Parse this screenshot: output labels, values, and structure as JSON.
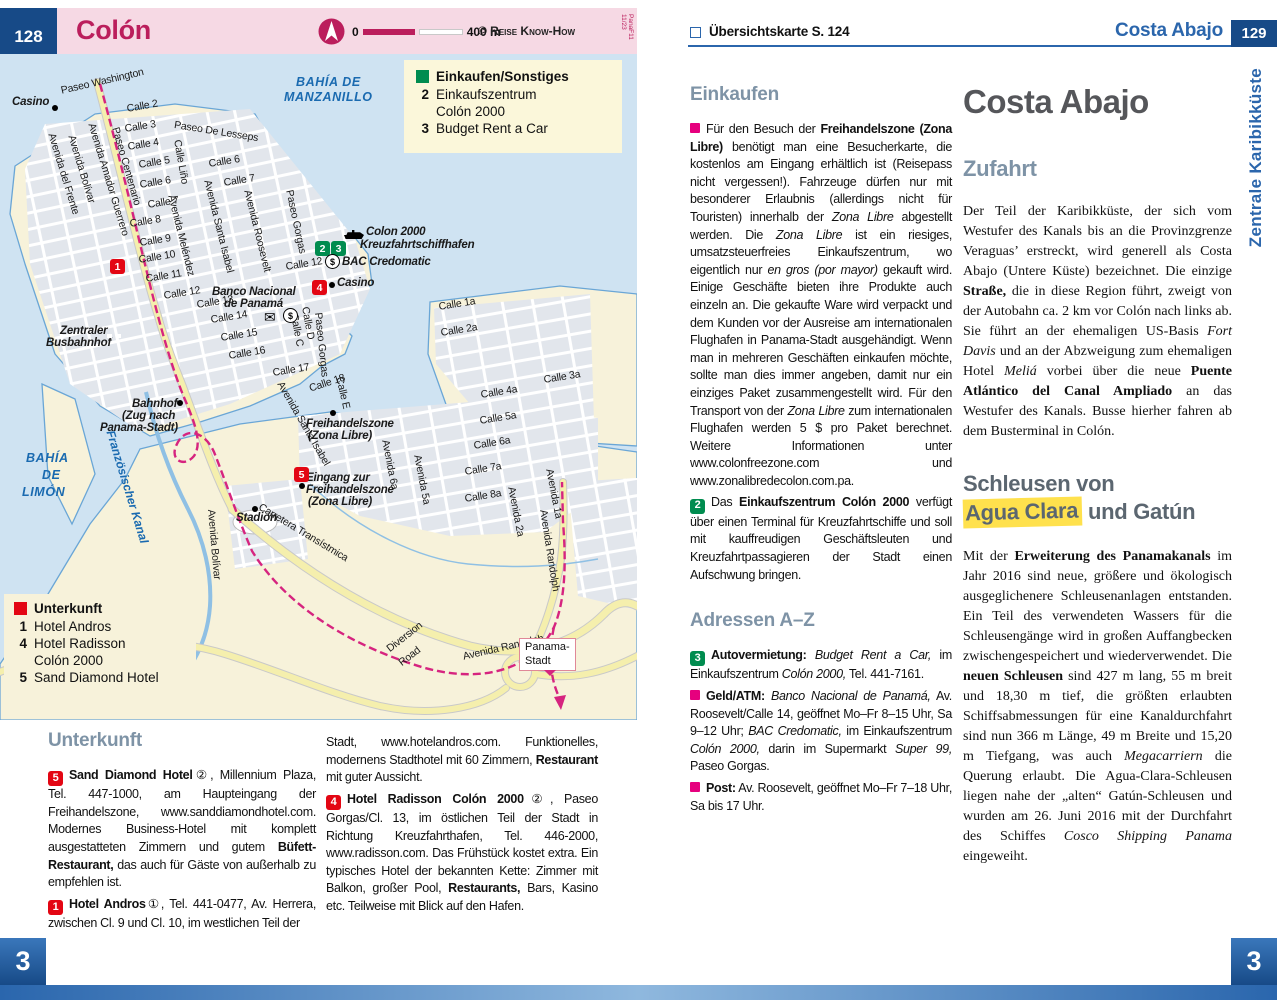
{
  "colors": {
    "accent_blue": "#2b66ac",
    "navy": "#174a87",
    "pink_header": "#f6d9e4",
    "title_crimson": "#bb1e5c",
    "marker_red": "#e30613",
    "marker_green": "#008c4f",
    "bullet_pink": "#e6007e",
    "heading_slate": "#7e93a6",
    "highlight_yellow": "#ffe14d",
    "map_water": "#cfe3f2",
    "map_land": "#f7f2da",
    "railway_magenta": "#d6247f"
  },
  "left_page": {
    "header": {
      "page_number": "128",
      "title": "Colón",
      "scale": {
        "start": "0",
        "end": "400 m"
      },
      "copyright": "© Reise Know-How",
      "edition": "PanaF11 11/23"
    },
    "map": {
      "legend_shopping": {
        "title": "Einkaufen/Sonstiges",
        "color": "#008c4f",
        "items": [
          {
            "num": "2",
            "label": "Einkaufszentrum\nColón 2000"
          },
          {
            "num": "3",
            "label": "Budget Rent a Car"
          }
        ]
      },
      "legend_lodging": {
        "title": "Unterkunft",
        "color": "#e30613",
        "items": [
          {
            "num": "1",
            "label": "Hotel Andros"
          },
          {
            "num": "4",
            "label": "Hotel Radisson\nColón 2000"
          },
          {
            "num": "5",
            "label": "Sand Diamond Hotel"
          }
        ]
      },
      "sign": {
        "line1": "Panama-",
        "line2": "Stadt"
      },
      "labels": [
        {
          "t": "BAHÍA DE",
          "x": 296,
          "y": 22,
          "c": "wb"
        },
        {
          "t": "MANZANILLO",
          "x": 284,
          "y": 37,
          "c": "wb"
        },
        {
          "t": "BAHÍA",
          "x": 26,
          "y": 398,
          "c": "wb"
        },
        {
          "t": "DE",
          "x": 42,
          "y": 415,
          "c": "wb"
        },
        {
          "t": "LIMÓN",
          "x": 22,
          "y": 432,
          "c": "wb"
        },
        {
          "t": "Französischer Kanal",
          "x": 116,
          "y": 375,
          "r": 73,
          "c": "wa"
        },
        {
          "t": "Casino",
          "x": 12,
          "y": 42,
          "c": "po"
        },
        {
          "t": "Colon 2000",
          "x": 366,
          "y": 172,
          "c": "po"
        },
        {
          "t": "Kreuzfahrtschiffhafen",
          "x": 360,
          "y": 185,
          "c": "po"
        },
        {
          "t": "BAC Credomatic",
          "x": 342,
          "y": 202,
          "c": "po"
        },
        {
          "t": "Casino",
          "x": 337,
          "y": 223,
          "c": "po"
        },
        {
          "t": "Banco Nacional",
          "x": 212,
          "y": 232,
          "c": "po"
        },
        {
          "t": "de Panamá",
          "x": 224,
          "y": 244,
          "c": "po"
        },
        {
          "t": "Zentraler",
          "x": 60,
          "y": 271,
          "c": "po"
        },
        {
          "t": "Busbahnhof",
          "x": 46,
          "y": 283,
          "c": "po"
        },
        {
          "t": "Bahnhof",
          "x": 132,
          "y": 344,
          "c": "po"
        },
        {
          "t": "(Zug nach",
          "x": 122,
          "y": 356,
          "c": "po"
        },
        {
          "t": "Panama-Stadt)",
          "x": 100,
          "y": 368,
          "c": "po"
        },
        {
          "t": "Freihandelszone",
          "x": 306,
          "y": 364,
          "c": "po"
        },
        {
          "t": "(Zona Libre)",
          "x": 308,
          "y": 376,
          "c": "po"
        },
        {
          "t": "Eingang zur",
          "x": 306,
          "y": 418,
          "c": "po"
        },
        {
          "t": "Freihandelszone",
          "x": 306,
          "y": 430,
          "c": "po"
        },
        {
          "t": "(Zona Libre)",
          "x": 308,
          "y": 442,
          "c": "po"
        },
        {
          "t": "Stadion",
          "x": 236,
          "y": 458,
          "c": "po"
        },
        {
          "t": "Paseo Washington",
          "x": 60,
          "y": 32,
          "r": -13
        },
        {
          "t": "Calle 2",
          "x": 126,
          "y": 50,
          "r": -10
        },
        {
          "t": "Calle 3",
          "x": 124,
          "y": 70,
          "r": -9
        },
        {
          "t": "Calle 4",
          "x": 127,
          "y": 88,
          "r": -9
        },
        {
          "t": "Calle 5",
          "x": 138,
          "y": 106,
          "r": -9
        },
        {
          "t": "Calle 6",
          "x": 139,
          "y": 126,
          "r": -9
        },
        {
          "t": "Calle 7",
          "x": 147,
          "y": 146,
          "r": -9
        },
        {
          "t": "Calle 8",
          "x": 129,
          "y": 165,
          "r": -9
        },
        {
          "t": "Calle 9",
          "x": 139,
          "y": 184,
          "r": -9
        },
        {
          "t": "Calle 10",
          "x": 138,
          "y": 201,
          "r": -9
        },
        {
          "t": "Calle 11",
          "x": 145,
          "y": 220,
          "r": -9
        },
        {
          "t": "Calle 12",
          "x": 163,
          "y": 237,
          "r": -9
        },
        {
          "t": "Paseo De Lesseps",
          "x": 175,
          "y": 66,
          "r": 9
        },
        {
          "t": "Avenida Amador Guerrero",
          "x": 96,
          "y": 68,
          "r": 73
        },
        {
          "t": "Paseo Centenario",
          "x": 120,
          "y": 72,
          "r": 74
        },
        {
          "t": "Avenida Bolívar",
          "x": 76,
          "y": 80,
          "r": 73
        },
        {
          "t": "Avenida del Frente",
          "x": 56,
          "y": 78,
          "r": 73
        },
        {
          "t": "Calle Liño",
          "x": 182,
          "y": 85,
          "r": 80
        },
        {
          "t": "Calle 6",
          "x": 208,
          "y": 105,
          "r": -9
        },
        {
          "t": "Calle 7",
          "x": 223,
          "y": 124,
          "r": -9
        },
        {
          "t": "Avenida Meléndez",
          "x": 176,
          "y": 140,
          "r": 76
        },
        {
          "t": "Avenida Santa Isabel",
          "x": 212,
          "y": 125,
          "r": 76
        },
        {
          "t": "Avenida Roosevelt",
          "x": 252,
          "y": 135,
          "r": 76
        },
        {
          "t": "Paseo Gorgas",
          "x": 294,
          "y": 135,
          "r": 78
        },
        {
          "t": "Calle 12",
          "x": 285,
          "y": 208,
          "r": -9
        },
        {
          "t": "Calle 13",
          "x": 196,
          "y": 246,
          "r": -9
        },
        {
          "t": "Calle 14",
          "x": 210,
          "y": 261,
          "r": -9
        },
        {
          "t": "Calle 15",
          "x": 220,
          "y": 279,
          "r": -9
        },
        {
          "t": "Calle 16",
          "x": 228,
          "y": 297,
          "r": -9
        },
        {
          "t": "Calle 17",
          "x": 272,
          "y": 314,
          "r": -9
        },
        {
          "t": "Calle 18",
          "x": 308,
          "y": 330,
          "r": -18
        },
        {
          "t": "Calle E",
          "x": 344,
          "y": 322,
          "r": 77
        },
        {
          "t": "Calle D",
          "x": 310,
          "y": 252,
          "r": 80
        },
        {
          "t": "Calle C",
          "x": 299,
          "y": 259,
          "r": 80
        },
        {
          "t": "Paseo Gorgas",
          "x": 323,
          "y": 258,
          "r": 84
        },
        {
          "t": "Avenida Santa Isabel",
          "x": 284,
          "y": 326,
          "r": 60
        },
        {
          "t": "Avenida Bolívar",
          "x": 216,
          "y": 455,
          "r": 85
        },
        {
          "t": "Calle 1a",
          "x": 438,
          "y": 248,
          "r": -9
        },
        {
          "t": "Calle 2a",
          "x": 440,
          "y": 274,
          "r": -9
        },
        {
          "t": "Calle 3a",
          "x": 543,
          "y": 321,
          "r": -9
        },
        {
          "t": "Calle 4a",
          "x": 480,
          "y": 336,
          "r": -9
        },
        {
          "t": "Calle 5a",
          "x": 479,
          "y": 362,
          "r": -9
        },
        {
          "t": "Calle 6a",
          "x": 473,
          "y": 387,
          "r": -9
        },
        {
          "t": "Calle 7a",
          "x": 464,
          "y": 413,
          "r": -9
        },
        {
          "t": "Calle 8a",
          "x": 464,
          "y": 440,
          "r": -9
        },
        {
          "t": "Avenida 6a",
          "x": 390,
          "y": 385,
          "r": 79
        },
        {
          "t": "Avenida 5a",
          "x": 422,
          "y": 400,
          "r": 79
        },
        {
          "t": "Avenida 2a",
          "x": 516,
          "y": 432,
          "r": 79
        },
        {
          "t": "Avenida 1a",
          "x": 554,
          "y": 414,
          "r": 79
        },
        {
          "t": "Avenida Randolph",
          "x": 548,
          "y": 455,
          "r": 81
        },
        {
          "t": "Avenida  Randolph",
          "x": 462,
          "y": 598,
          "r": -13
        },
        {
          "t": "Diversion",
          "x": 385,
          "y": 592,
          "r": -38
        },
        {
          "t": "Road",
          "x": 397,
          "y": 606,
          "r": -38
        },
        {
          "t": "Carretera Transístmica",
          "x": 262,
          "y": 448,
          "r": 31
        }
      ],
      "markers": [
        {
          "k": "dot",
          "x": 52,
          "y": 51
        },
        {
          "k": "red",
          "n": "1",
          "x": 110,
          "y": 205
        },
        {
          "k": "green",
          "n": "2",
          "x": 315,
          "y": 187
        },
        {
          "k": "green",
          "n": "3",
          "x": 331,
          "y": 187
        },
        {
          "k": "ship",
          "x": 344,
          "y": 176
        },
        {
          "k": "dollar",
          "x": 325,
          "y": 200
        },
        {
          "k": "red",
          "n": "4",
          "x": 312,
          "y": 226
        },
        {
          "k": "dot",
          "x": 329,
          "y": 228
        },
        {
          "k": "env",
          "x": 264,
          "y": 256
        },
        {
          "k": "dollar",
          "x": 283,
          "y": 254
        },
        {
          "k": "bus",
          "x": 114,
          "y": 278
        },
        {
          "k": "dot",
          "x": 177,
          "y": 346
        },
        {
          "k": "dot",
          "x": 330,
          "y": 356
        },
        {
          "k": "red",
          "n": "5",
          "x": 294,
          "y": 413
        },
        {
          "k": "dot",
          "x": 299,
          "y": 429
        },
        {
          "k": "dot",
          "x": 252,
          "y": 452
        }
      ]
    },
    "unterkunft": {
      "heading": "Unterkunft",
      "col1": [
        {
          "m": {
            "k": "red",
            "n": "5"
          },
          "t": "**Sand Diamond Hotel**②, Millennium Plaza, Tel. 447-1000, am Haupteingang der Freihandelszone, www.sanddiamondhotel.com. Modernes Business-Hotel mit komplett ausgestatteten Zimmern und gutem **Büfett-Restaurant,** das auch für Gäste von außerhalb zu empfehlen ist."
        },
        {
          "m": {
            "k": "red",
            "n": "1"
          },
          "t": "**Hotel Andros**①, Tel. 441-0477, Av. Herrera, zwischen Cl. 9 und Cl. 10, im westlichen Teil der"
        }
      ],
      "col2": [
        {
          "t": "Stadt, www.hotelandros.com. Funktionelles, modernens Stadthotel mit 60 Zimmern, **Restaurant** mit guter Aussicht."
        },
        {
          "m": {
            "k": "red",
            "n": "4"
          },
          "t": "**Hotel Radisson Colón 2000**②, Paseo Gorgas/Cl. 13, im östlichen Teil der Stadt in Richtung Kreuzfahrthafen, Tel. 446-2000, www.radisson.com. Das Frühstück kostet extra. Ein typisches Hotel der bekannten Kette: Zimmer mit Balkon, großer Pool, **Restaurants,** Bars, Kasino etc. Teilweise mit Blick auf den Hafen."
        }
      ]
    },
    "corner": "3"
  },
  "right_page": {
    "header": {
      "overview": "Übersichtskarte S. 124",
      "section": "Costa Abajo",
      "page_number": "129"
    },
    "side_tab": "Zentrale Karibikküste",
    "einkaufen": {
      "heading": "Einkaufen",
      "paragraphs": [
        {
          "m": {
            "k": "pink"
          },
          "t": "Für den Besuch der **Freihandelszone (Zona Libre)** benötigt man eine Besucherkarte, die kostenlos am Eingang erhältlich ist (Reisepass nicht vergessen!). Fahrzeuge dürfen nur mit besonderer Erlaubnis (allerdings nicht für Touristen) innerhalb der *Zona Libre* abgestellt werden. Die *Zona Libre* ist ein riesiges, umsatzsteuerfreies Einkaufszentrum, wo eigentlich nur *en gros (por mayor)* gekauft wird. Einige Geschäfte bieten ihre Produkte auch einzeln an. Die gekaufte Ware wird verpackt und dem Kunden vor der Ausreise am internationalen Flughafen in Panama-Stadt ausgehändigt. Wenn man in mehreren Geschäften einkaufen möchte, sollte man dies immer angeben, damit nur ein einziges Paket zusammengestellt wird. Für den Transport von der *Zona Libre* zum internationalen Flughafen werden 5 $ pro Paket berechnet. Weitere Informationen unter www.colonfreezone.com und www.zonalibredecolon.com.pa."
        },
        {
          "m": {
            "k": "green",
            "n": "2"
          },
          "t": "Das **Einkaufszentrum Colón 2000** verfügt über einen Terminal für Kreuzfahrtschiffe und soll mit kauffreudigen Geschäftsleuten und Kreuzfahrtpassagieren der Stadt einen Aufschwung bringen."
        }
      ],
      "adressen_heading": "Adressen A–Z",
      "adressen": [
        {
          "m": {
            "k": "green",
            "n": "3"
          },
          "t": "**Autovermietung:** *Budget Rent a Car,* im Einkaufszentrum *Colón 2000,* Tel. 441-7161."
        },
        {
          "m": {
            "k": "pink"
          },
          "t": "**Geld/ATM:** *Banco Nacional de Panamá,* Av. Roosevelt/Calle 14, geöffnet Mo–Fr 8–15 Uhr, Sa 9–12 Uhr; *BAC Credomatic,* im Einkaufszentrum *Colón 2000,* darin im Supermarkt *Super 99,* Paseo Gorgas."
        },
        {
          "m": {
            "k": "pink"
          },
          "t": "**Post:** Av. Roosevelt, geöffnet Mo–Fr 7–18 Uhr, Sa bis 17 Uhr."
        }
      ]
    },
    "costa": {
      "title": "Costa Abajo",
      "zufahrt_heading": "Zufahrt",
      "zufahrt_paras": [
        {
          "t": "Der Teil der Karibikküste, der sich vom Westufer des Kanals bis an die Provinzgrenze Veraguas’ erstreckt, wird generell als Costa Abajo (Untere Küste) bezeichnet. Die einzige **Straße,** die in diese Region führt, zweigt von der Autobahn ca. 2 km vor Colón nach links ab. Sie führt an der ehemaligen US-Basis *Fort Davis* und an der Abzweigung zum ehemaligen Hotel *Meliá* vorbei über die neue **Puente Atlántico del Canal Ampliado** an das Westufer des Kanals. Busse hierher fahren ab dem Busterminal in Colón."
        }
      ],
      "schleusen_line1": "Schleusen von",
      "schleusen_highlight": "Agua Clara",
      "schleusen_line2_rest": " und Gatún",
      "schleusen_paras": [
        {
          "t": "Mit der **Erweiterung des Panamakanals** im Jahr 2016 sind neue, größere und ökologisch ausgeglichenere Schleusenanlagen entstanden. Ein Teil des verwendeten Wassers für die Schleusengänge wird in großen Auffangbecken zwischengespeichert und wiederverwendet. Die **neuen Schleusen** sind 427 m lang, 55 m breit und 18,30 m tief, die größten erlaubten Schiffsabmessungen für eine Kanaldurchfahrt sind nun 366 m Länge, 49 m Breite und 15,20 m Tiefgang, was auch *Megacarriern* die Querung erlaubt. Die Agua-Clara-Schleusen liegen nahe der „alten“ Gatún-Schleusen und wurden am 26. Juni 2016 mit der Durchfahrt des Schiffes *Cosco Shipping Panama* eingeweiht."
        }
      ]
    },
    "corner": "3"
  }
}
